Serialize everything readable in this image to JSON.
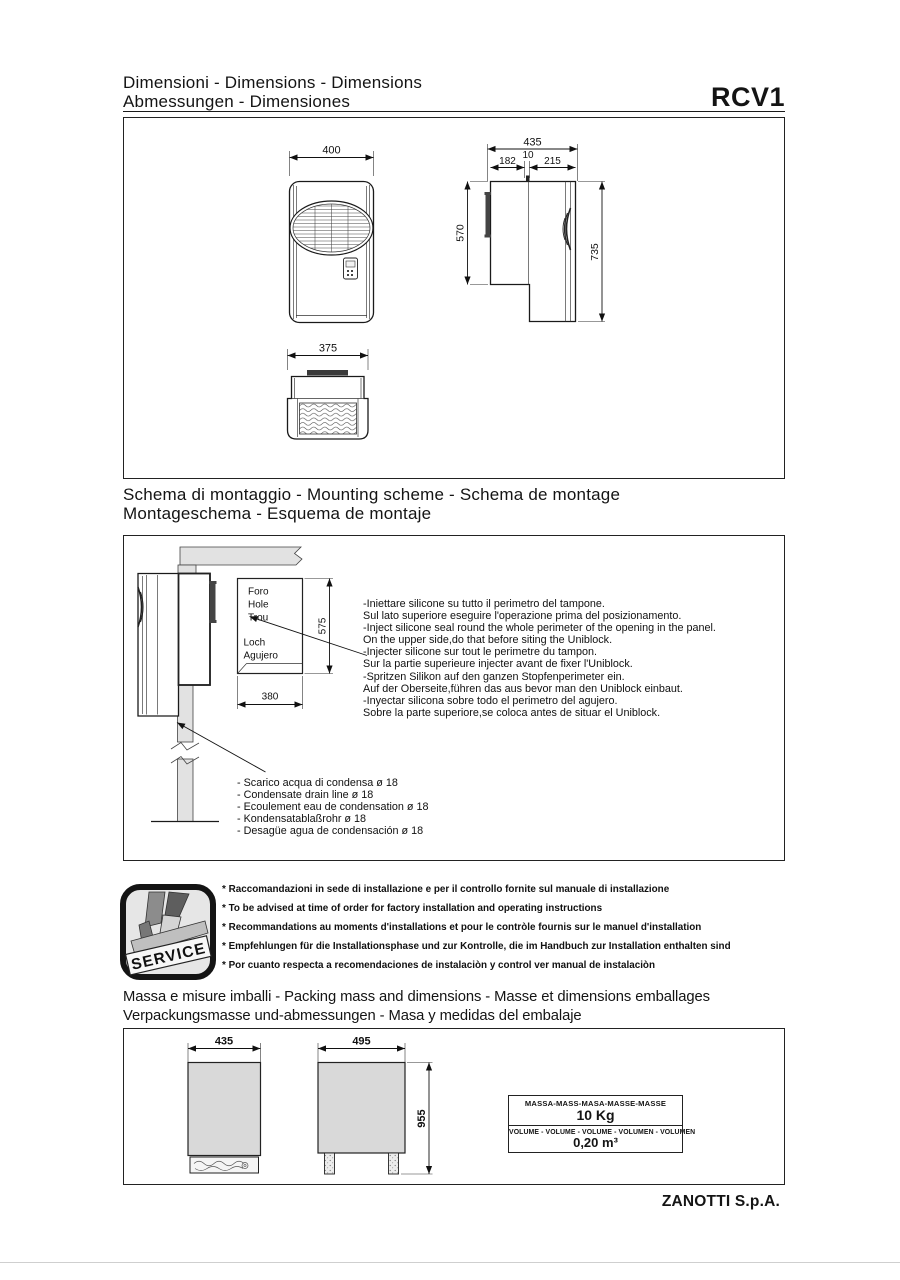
{
  "page": {
    "title_line1": "Dimensioni - Dimensions - Dimensions",
    "title_line2": "Abmessungen - Dimensiones",
    "product_code": "RCV1",
    "footer": "ZANOTTI S.p.A."
  },
  "dimensions_box": {
    "front_width": "400",
    "base_width": "375",
    "side_total_width": "435",
    "side_panel_gap": "10",
    "side_left_width": "182",
    "side_right_width": "215",
    "side_inner_height": "570",
    "side_total_height": "735"
  },
  "mounting": {
    "heading_line1": "Schema di montaggio - Mounting scheme - Schema de montage",
    "heading_line2": "Montageschema - Esquema de montaje",
    "hole_labels": [
      "Foro",
      "Hole",
      "Trou",
      "Loch",
      "Agujero"
    ],
    "hole_height": "575",
    "hole_width": "380",
    "instructions": [
      "-Iniettare silicone su tutto il perimetro del tampone.",
      "Sul lato superiore eseguire l'operazione prima del posizionamento.",
      "-Inject silicone seal round the whole perimeter of the opening in the panel.",
      "On the upper side,do that before siting the Uniblock.",
      "-Injecter silicone sur tout le perimetre du tampon.",
      "Sur la partie superieure injecter avant de fixer l'Uniblock.",
      "-Spritzen Silikon auf den ganzen Stopfenperimeter ein.",
      "Auf der Oberseite,führen das aus bevor man den Uniblock einbaut.",
      "-Inyectar silicona sobre todo el perimetro del agujero.",
      "Sobre la parte superiore,se coloca antes de situar el Uniblock."
    ],
    "drain_notes": [
      "- Scarico acqua di condensa ø 18",
      "- Condensate drain line ø 18",
      "- Ecoulement eau de condensation ø 18",
      "- Kondensatablaßrohr ø 18",
      "- Desagüe agua de condensación ø 18"
    ]
  },
  "service": {
    "icon_label": "SERVICE",
    "notes": [
      "* Raccomandazioni in sede di installazione e per il controllo fornite sul manuale di installazione",
      "* To be advised at time of order for factory installation and operating instructions",
      "* Recommandations au moments d'installations et pour le contròle fournis sur le manuel d'installation",
      "* Empfehlungen für die Installationsphase und zur Kontrolle, die im Handbuch zur Installation enthalten sind",
      "* Por cuanto respecta a recomendaciones de instalaciòn y control ver manual de instalaciòn"
    ]
  },
  "packing": {
    "heading_line1": "Massa e misure imballi - Packing mass and dimensions - Masse et dimensions emballages",
    "heading_line2": "Verpackungsmasse und-abmessungen - Masa y medidas del embalaje",
    "pack_front_width": "435",
    "pack_side_width": "495",
    "pack_height": "955",
    "mass_header": "MASSA-MASS-MASA-MASSE-MASSE",
    "mass_value": "10 Kg",
    "volume_header": "VOLUME - VOLUME - VOLUME - VOLUMEN - VOLUMEN",
    "volume_value": "0,20 m³"
  }
}
